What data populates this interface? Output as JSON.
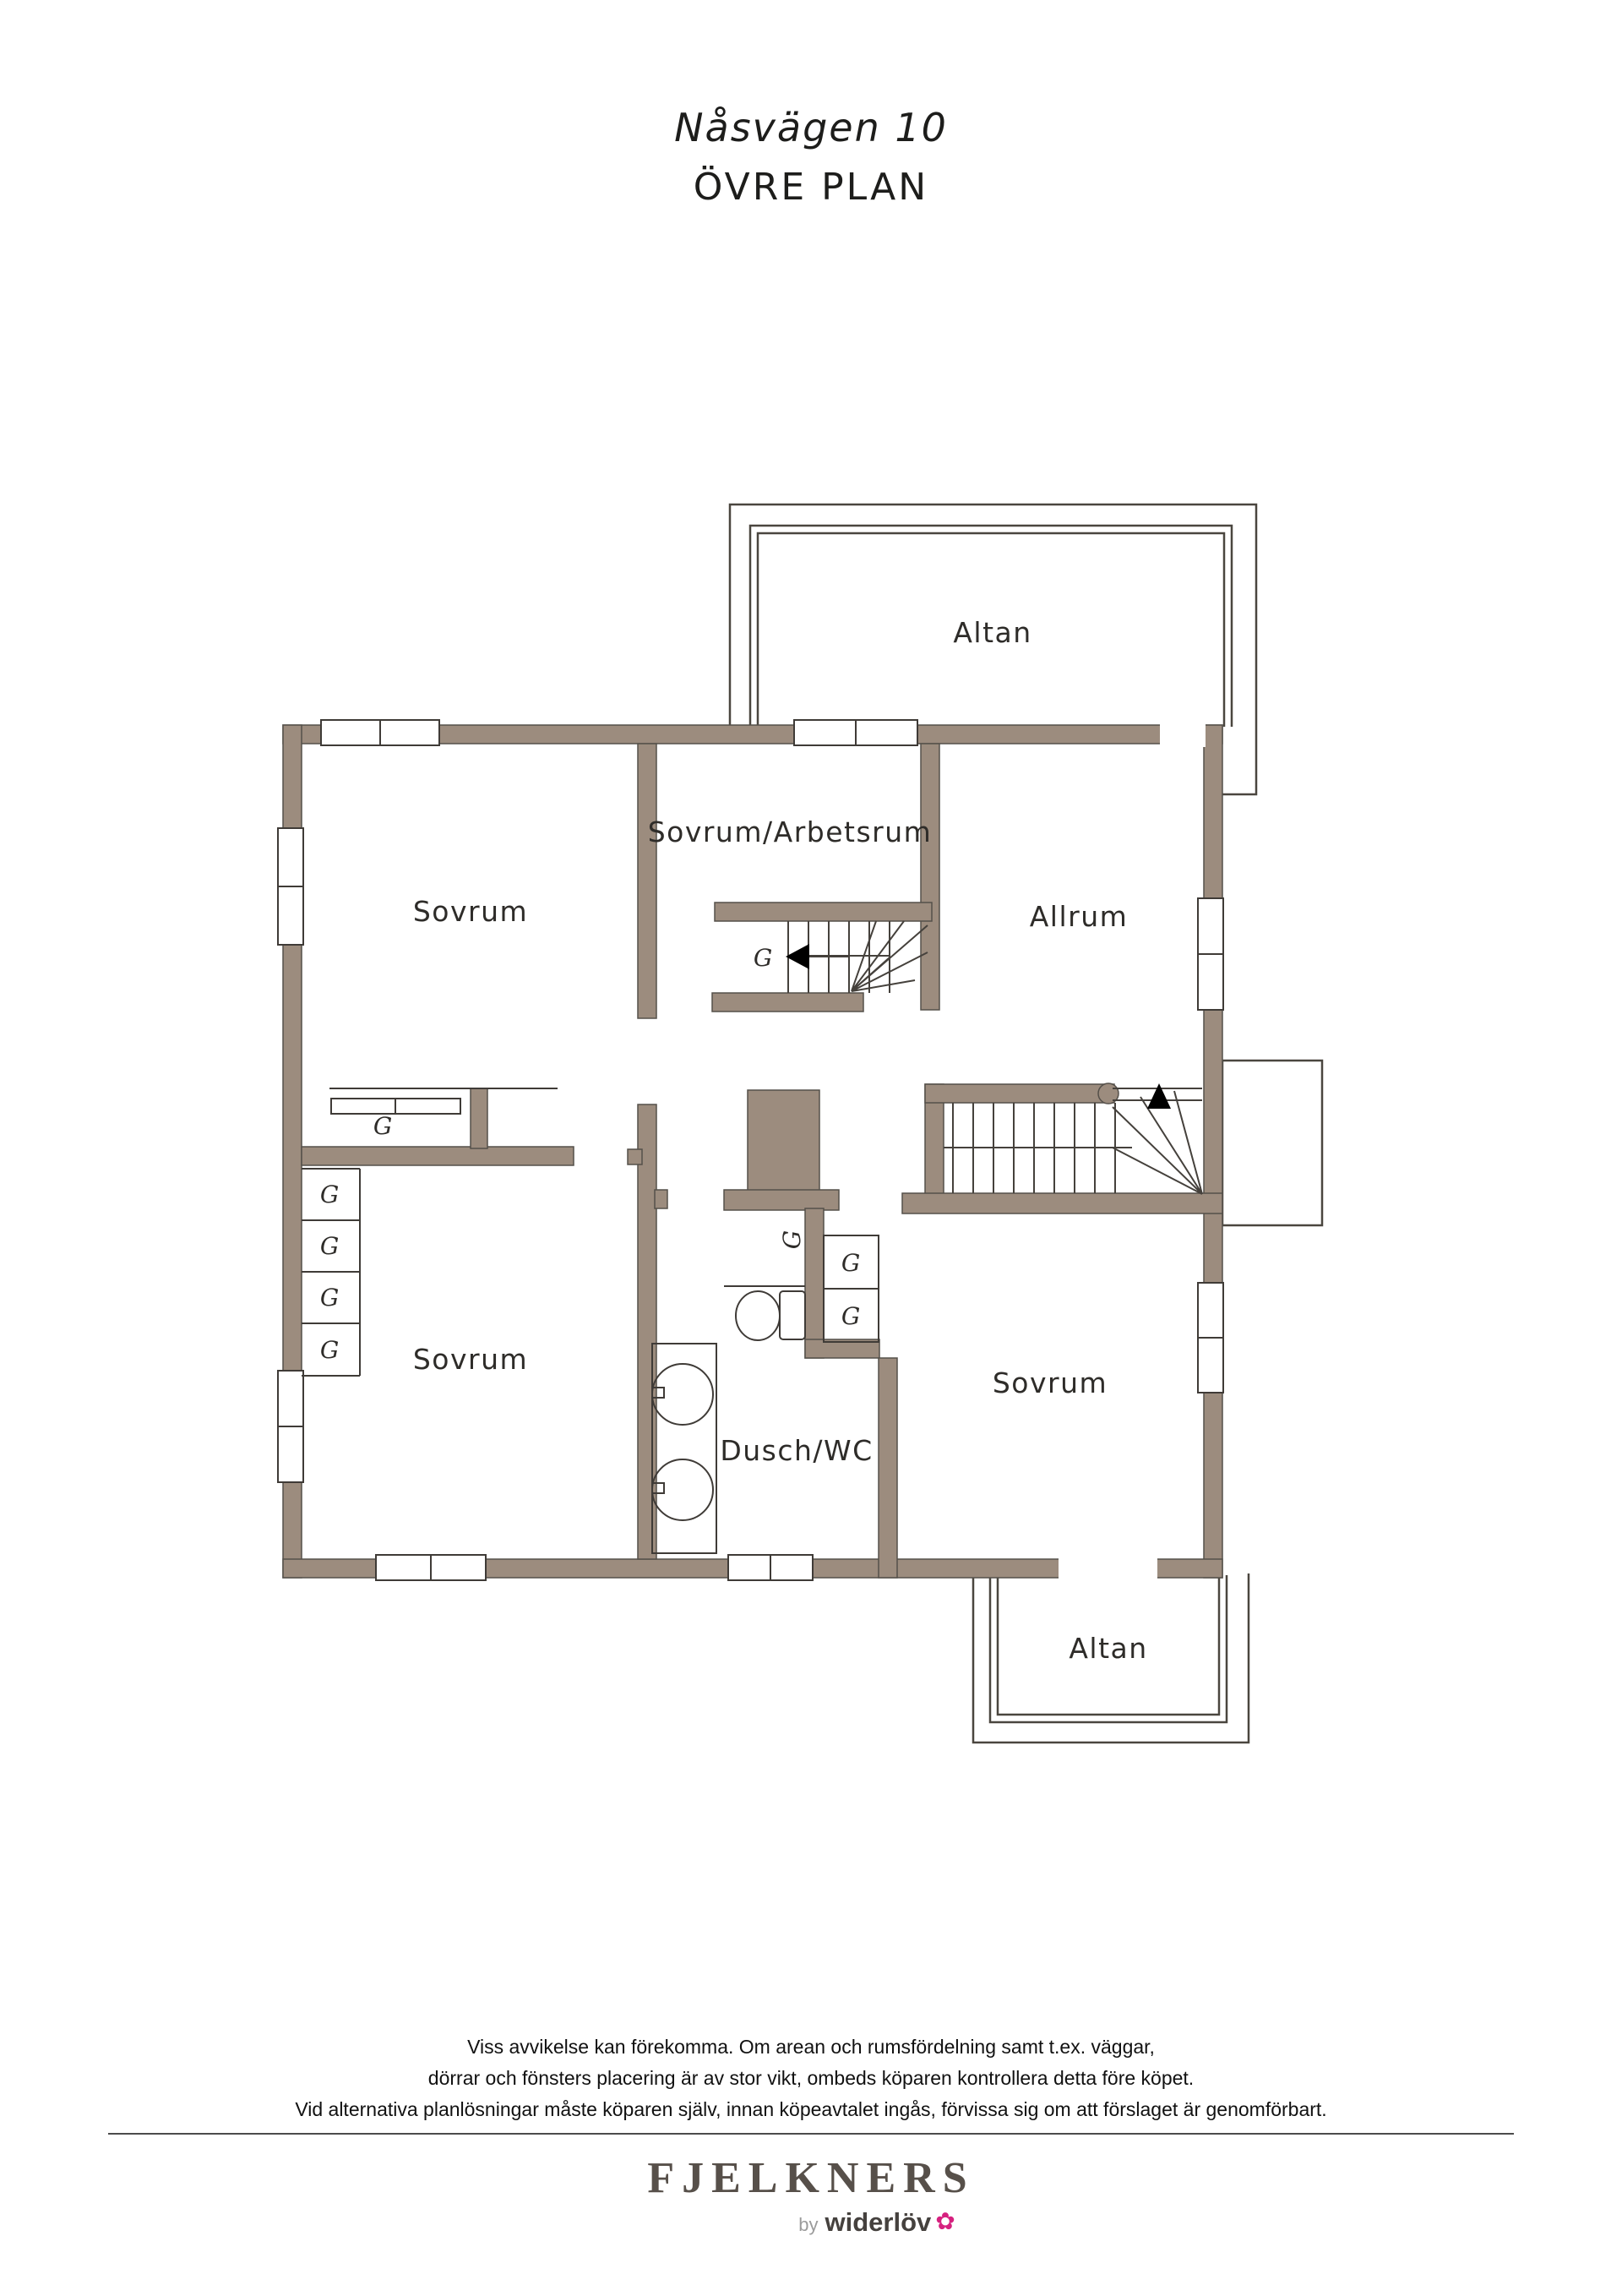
{
  "title": {
    "address": "Nåsvägen 10",
    "floor": "ÖVRE PLAN"
  },
  "rooms": {
    "altan_top": "Altan",
    "sovrum_upper_left": "Sovrum",
    "sovrum_arbetsrum": "Sovrum/Arbetsrum",
    "allrum": "Allrum",
    "sovrum_lower_left": "Sovrum",
    "dusch_wc": "Dusch/WC",
    "sovrum_lower_right": "Sovrum",
    "altan_bottom": "Altan"
  },
  "labels": {
    "closet": "G"
  },
  "disclaimer": {
    "line1": "Viss avvikelse kan förekomma. Om arean och rumsfördelning samt t.ex. väggar,",
    "line2": "dörrar och fönsters placering är av stor vikt, ombeds köparen kontrollera detta före köpet.",
    "line3": "Vid alternativa planlösningar måste köparen själv, innan köpeavtalet ingås, förvissa sig om att förslaget är genomförbart."
  },
  "footer": {
    "brand": "FJELKNERS",
    "by_prefix": "by",
    "by_brand": "widerlöv",
    "flower_icon": "flower-icon"
  },
  "colors": {
    "wall": "#9c8c7e",
    "sketch_line": "#3f3b37",
    "flower_pink": "#d6217f"
  }
}
